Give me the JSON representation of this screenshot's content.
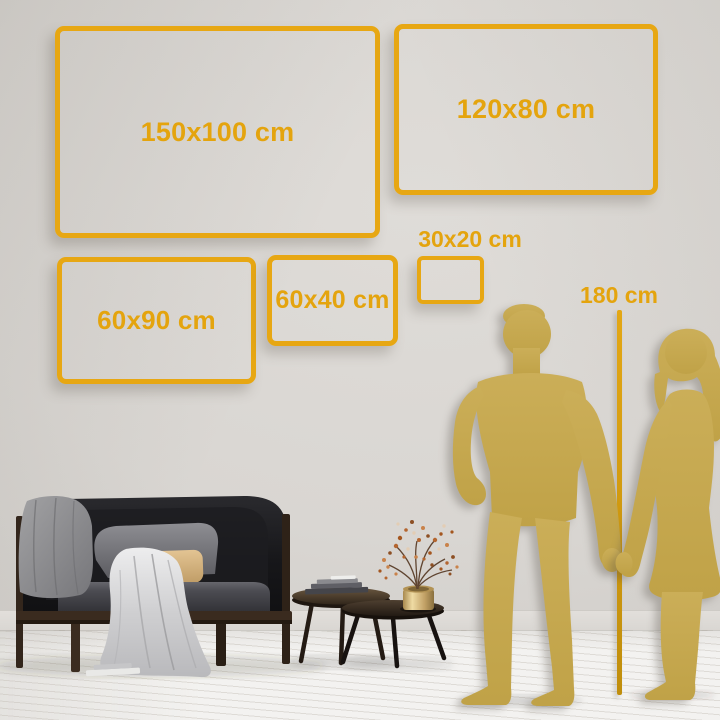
{
  "size_chart": {
    "frames": [
      {
        "label": "150x100 cm"
      },
      {
        "label": "120x80 cm"
      },
      {
        "label": "60x90 cm"
      },
      {
        "label": "60x40 cm"
      },
      {
        "label": "30x20 cm"
      }
    ],
    "height_marker": {
      "label": "180 cm"
    }
  },
  "figures": {
    "man": "man-silhouette",
    "woman": "woman-silhouette"
  },
  "colors": {
    "accent_gold": "#E7A713",
    "label_gold": "#E4A40E",
    "figure_gold": "#C9AC55",
    "marker_line_gold": "#D79E12",
    "wall": "#D9D6D2",
    "floor": "#F2F1EF"
  }
}
